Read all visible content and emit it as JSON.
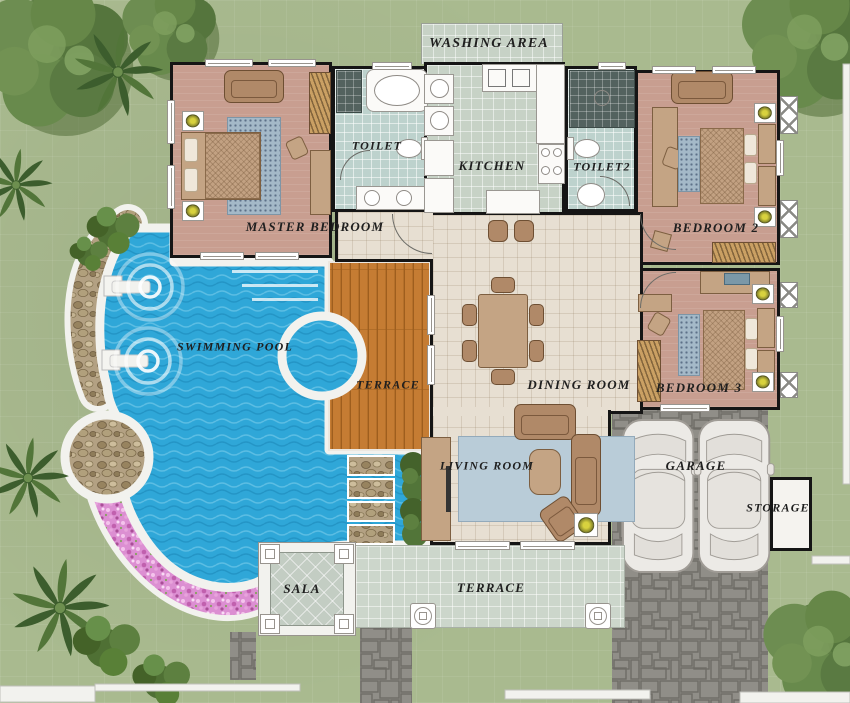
{
  "rooms": {
    "washing_area": {
      "label": "WASHING AREA"
    },
    "toilet": {
      "label": "TOILET"
    },
    "kitchen": {
      "label": "KITCHEN"
    },
    "toilet2": {
      "label": "TOILET2"
    },
    "master_bedroom": {
      "label": "MASTER BEDROOM"
    },
    "bedroom2": {
      "label": "BEDROOM 2"
    },
    "bedroom3": {
      "label": "BEDROOM 3"
    },
    "dining_room": {
      "label": "DINING ROOM"
    },
    "living_room": {
      "label": "LIVING ROOM"
    },
    "swimming_pool": {
      "label": "SWIMMING POOL"
    },
    "terrace_pool": {
      "label": "TERRACE"
    },
    "terrace_south": {
      "label": "TERRACE"
    },
    "garage": {
      "label": "GARAGE"
    },
    "storage": {
      "label": "STORAGE"
    },
    "sala": {
      "label": "SALA"
    }
  },
  "colors": {
    "lawn": "#a9ba8f",
    "pool": "#2fa7d8",
    "pool_dark": "#1b86b8",
    "pool_light": "#7fd0ec",
    "deck_wood": "#c57c33",
    "deck_wood_dark": "#9e5e1e",
    "bedroom_floor": "#c89e90",
    "tile_bath": "#bdd2cd",
    "tile_kitchen": "#c7d2c6",
    "hall_floor": "#e7dfd2",
    "terrace_tile": "#ccd6cb",
    "paving": "#908e88",
    "paving_dark": "#6e6c66",
    "flower_pink": "#dc8fd2",
    "pebble": "#b3a183",
    "wall": "#151515",
    "furniture_tan": "#c4a484",
    "furniture_brown": "#b08968",
    "rug_blue": "#b9ccd8",
    "label_text": "#1f1f1f",
    "white_trim": "#f2f2ee"
  }
}
